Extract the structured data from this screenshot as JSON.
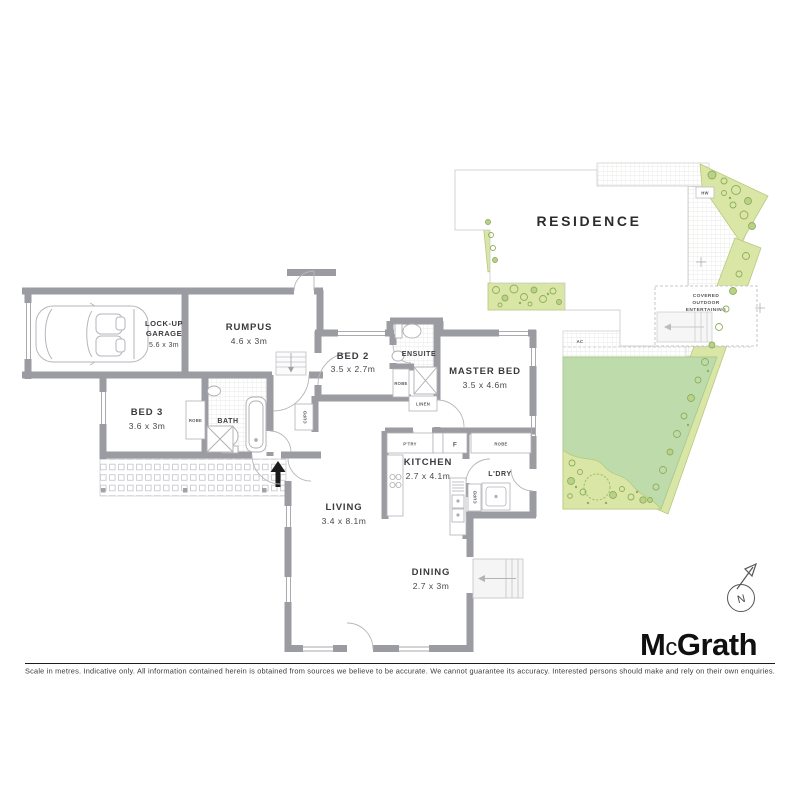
{
  "rooms": {
    "garage": {
      "name_line1": "LOCK-UP",
      "name_line2": "GARAGE",
      "dims": "5.6 x 3m"
    },
    "rumpus": {
      "name": "RUMPUS",
      "dims": "4.6 x 3m"
    },
    "bed2": {
      "name": "BED 2",
      "dims": "3.5 x 2.7m"
    },
    "ensuite": {
      "name": "ENSUITE"
    },
    "master_bed": {
      "name": "MASTER BED",
      "dims": "3.5 x 4.6m"
    },
    "bed3": {
      "name": "BED 3",
      "dims": "3.6 x 3m"
    },
    "bath": {
      "name": "BATH"
    },
    "kitchen": {
      "name": "KITCHEN",
      "dims": "2.7 x 4.1m"
    },
    "laundry": {
      "name": "L'DRY"
    },
    "living": {
      "name": "LIVING",
      "dims": "3.4 x 8.1m"
    },
    "dining": {
      "name": "DINING",
      "dims": "2.7 x 3m"
    }
  },
  "fixtures": {
    "robe": "ROBE",
    "linen": "LINEN",
    "cupd": "CUPD",
    "pantry": "P'TRY",
    "fridge": "F"
  },
  "site": {
    "residence": "RESIDENCE",
    "covered_line1": "COVERED",
    "covered_line2": "OUTDOOR",
    "covered_line3": "ENTERTAINING",
    "hw": "HW",
    "ac": "AC"
  },
  "compass": {
    "north": "N"
  },
  "brand": {
    "m": "M",
    "c": "c",
    "grath": "Grath"
  },
  "footer": {
    "disclaimer": "Scale in metres. Indicative only. All information contained herein is obtained from sources we believe to be accurate. We cannot guarantee its accuracy. Interested persons should make and rely on their own enquiries."
  },
  "colors": {
    "wall": "#9b9ba2",
    "lawn": "#bedcab",
    "garden_bed": "#d9e6a5",
    "plant_stroke": "#8fae5d",
    "thin_line": "#b3b3b8",
    "text": "#3b3b3f"
  }
}
